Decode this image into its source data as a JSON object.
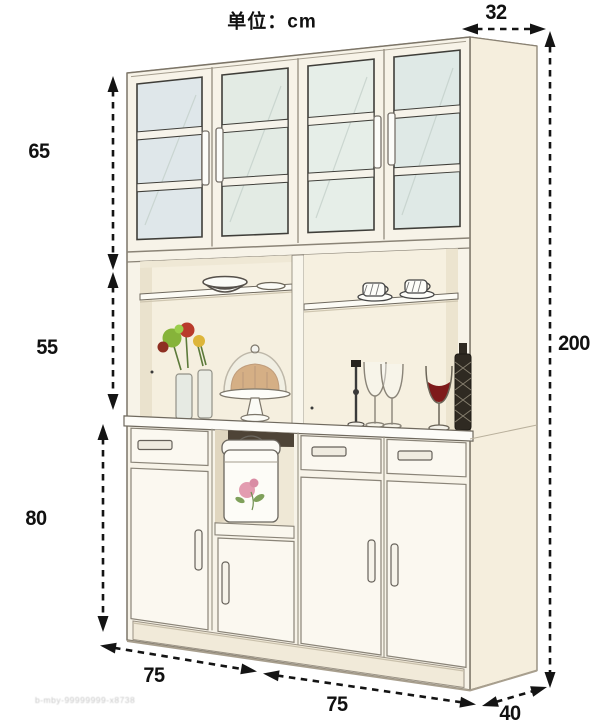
{
  "unit_label": "单位：cm",
  "dimensions": {
    "top_depth_cm": "32",
    "upper_section_height_cm": "65",
    "middle_section_height_cm": "55",
    "lower_section_height_cm": "80",
    "total_height_cm": "200",
    "bottom_left_width_cm": "75",
    "bottom_right_width_cm": "75",
    "bottom_depth_cm": "40"
  },
  "watermark_text": "b-mby-99999999-x8738",
  "palette": {
    "dimension_ink": "#141414",
    "outline": "#7c7568",
    "cabinet_front": "#f7f3e8",
    "cabinet_side": "#f5eedd",
    "glass_tint": "#e0e9e6",
    "counter_white": "#fdfcf8",
    "niche_shadow": "#4e4437",
    "wine_red": "#7e1a1a",
    "flower_green": "#86b33a",
    "flower_red": "#b93a2b",
    "flower_yellow": "#ddb53a",
    "cake_brown": "#c17a33",
    "decal_pink": "#e39cb0"
  }
}
